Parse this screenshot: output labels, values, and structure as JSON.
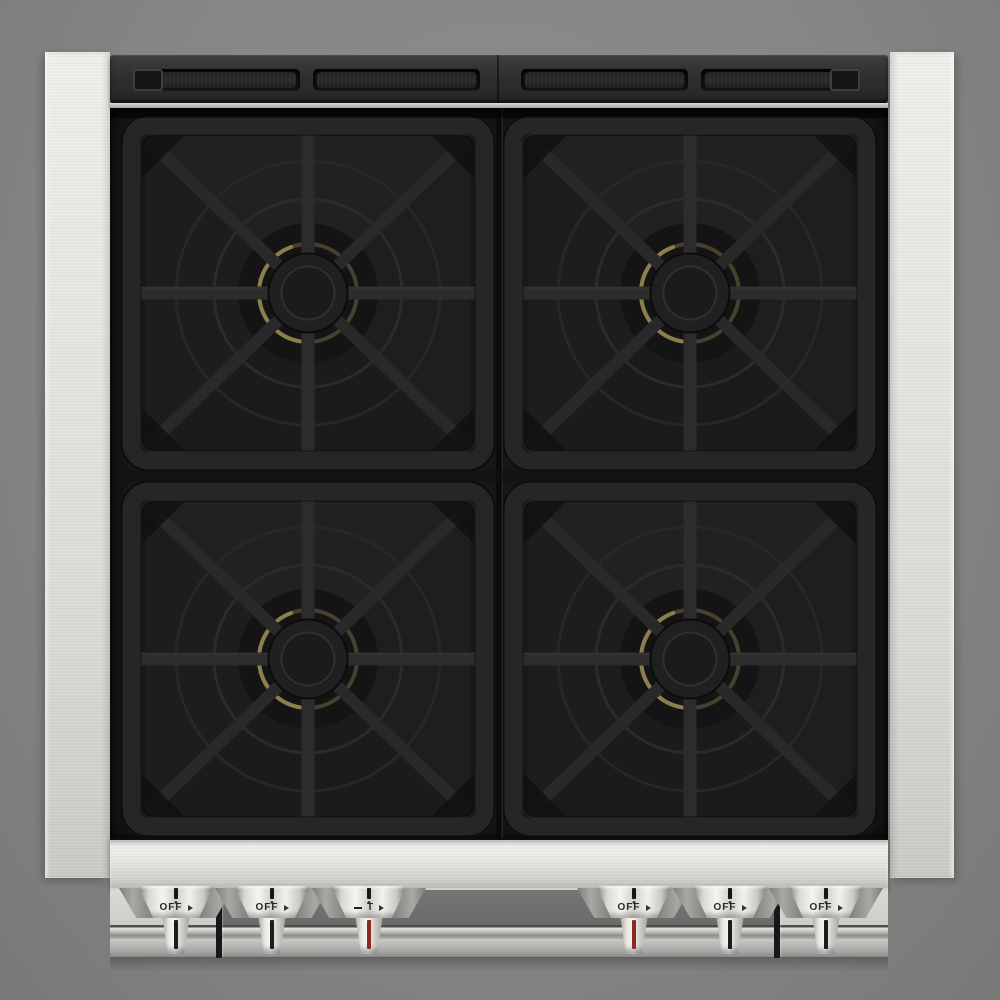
{
  "scene": {
    "subject": "Top-down product view of a four-burner stainless steel gas range",
    "style": "black cast-iron burner grates on a dark cooktop, brushed stainless frame, gray backdrop"
  },
  "cooktop": {
    "burner_count": 4,
    "burners": [
      {
        "id": "burner-top-left"
      },
      {
        "id": "burner-top-right"
      },
      {
        "id": "burner-bottom-left"
      },
      {
        "id": "burner-bottom-right"
      }
    ],
    "grate_style": "square grate with center ring, cross bars and X diagonals",
    "vent_slot_count": 4
  },
  "controls": {
    "knob_count": 6,
    "knobs": [
      {
        "id": "burner-knob-1",
        "label": "OFF",
        "indicator_color": "#1c1c1c",
        "pointer_icon": "knob-pointer-tick",
        "side_icon": "flame-high-icon"
      },
      {
        "id": "burner-knob-2",
        "label": "OFF",
        "indicator_color": "#1c1c1c",
        "pointer_icon": "knob-pointer-tick",
        "side_icon": "flame-high-icon"
      },
      {
        "id": "oven-temp-knob",
        "label": "T",
        "indicator_color": "#8a2b23",
        "pointer_icon": "knob-pointer-tick",
        "left_icon": "temp-low-mark-icon",
        "side_icon": "temp-high-mark-icon"
      },
      {
        "id": "burner-knob-4",
        "label": "OFF",
        "indicator_color": "#8a2b23",
        "pointer_icon": "knob-pointer-tick",
        "side_icon": "flame-high-icon"
      },
      {
        "id": "burner-knob-5",
        "label": "OFF",
        "indicator_color": "#1c1c1c",
        "pointer_icon": "knob-pointer-tick",
        "side_icon": "flame-high-icon"
      },
      {
        "id": "burner-knob-6",
        "label": "OFF",
        "indicator_color": "#1c1c1c",
        "pointer_icon": "knob-pointer-tick",
        "side_icon": "flame-high-icon"
      }
    ]
  },
  "colors": {
    "background": "#868685",
    "stainless_light": "#eceae6",
    "stainless_mid": "#cfcecb",
    "vent_panel": "#2e2e2e",
    "cooktop_black": "#161616",
    "grate_black": "#262626",
    "brass_burner_ring": "#8d7e4d",
    "indicator_black": "#1c1c1c",
    "indicator_red": "#8a2b23"
  }
}
